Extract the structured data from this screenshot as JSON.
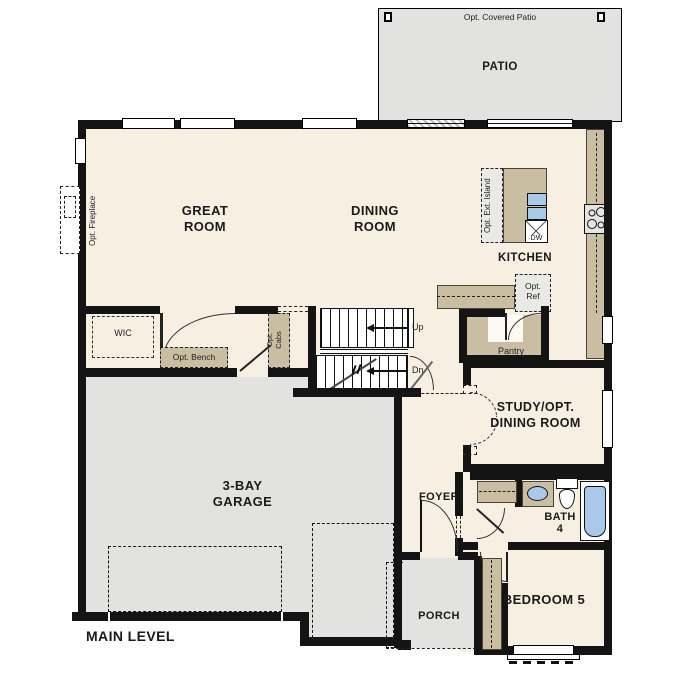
{
  "title": "MAIN LEVEL",
  "colors": {
    "wall": "#141414",
    "floor": "#f6efe2",
    "concrete": "#e2e2e0",
    "counter": "#c9bda2",
    "fixture_blue": "#aac9e9",
    "optional_fill": "#e9e9e6"
  },
  "patio": {
    "label": "PATIO",
    "note": "Opt. Covered Patio"
  },
  "rooms": {
    "great_room": {
      "line1": "GREAT",
      "line2": "ROOM"
    },
    "dining_room": {
      "line1": "DINING",
      "line2": "ROOM"
    },
    "kitchen": {
      "label": "KITCHEN"
    },
    "garage": {
      "line1": "3-BAY",
      "line2": "GARAGE"
    },
    "study": {
      "line1": "STUDY/OPT.",
      "line2": "DINING ROOM"
    },
    "foyer": {
      "label": "FOYER"
    },
    "bath": {
      "line1": "BATH",
      "line2": "4"
    },
    "porch": {
      "label": "PORCH"
    },
    "bedroom5": {
      "label": "BEDROOM 5"
    },
    "wic": {
      "label": "WIC"
    },
    "pantry": {
      "label": "Pantry"
    }
  },
  "features": {
    "opt_fireplace": "Opt. Fireplace",
    "opt_ext_island": "Opt. Ext. Island",
    "dishwasher": "DW",
    "opt_ref_line1": "Opt.",
    "opt_ref_line2": "Ref",
    "opt_bench": "Opt. Bench",
    "opt_cabs_line1": "Opt.",
    "opt_cabs_line2": "Cabs",
    "stairs_up": "Up",
    "stairs_down": "Dn"
  }
}
